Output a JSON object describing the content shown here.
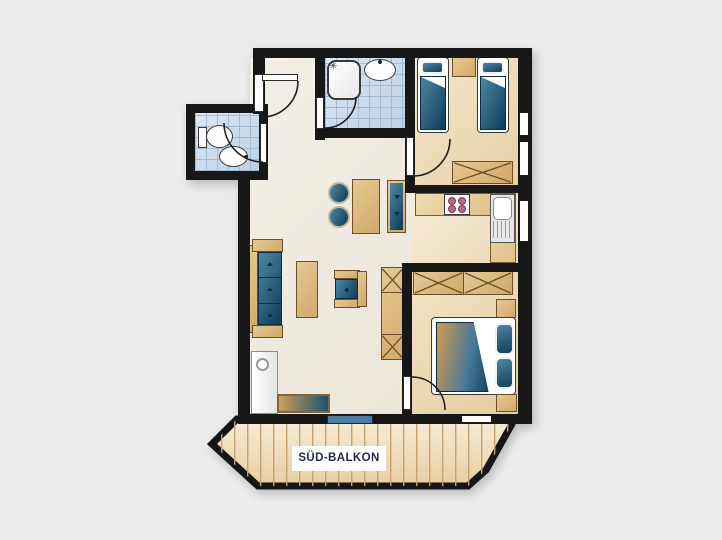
{
  "balcony": {
    "label": "SÜD-BALKON"
  },
  "icons": {
    "shower_head_icon": "✳"
  },
  "colors": {
    "wall": "#171717",
    "canvas_background": "#ebecec",
    "living_floor": "#f1ece3",
    "twin_bedroom_floor": "#ecd9b2",
    "double_bedroom_floor": "#ecd8ae",
    "kitchen_floor": "#f2e3c8",
    "tile_floor": "#cfe0ef",
    "wood_furniture": "#dcb87d",
    "upholstery_blue": "#17506e",
    "balcony_floor": "#f2e3c6",
    "balcony_door": "#4a7da1",
    "stove_burner": "#bc6585"
  }
}
